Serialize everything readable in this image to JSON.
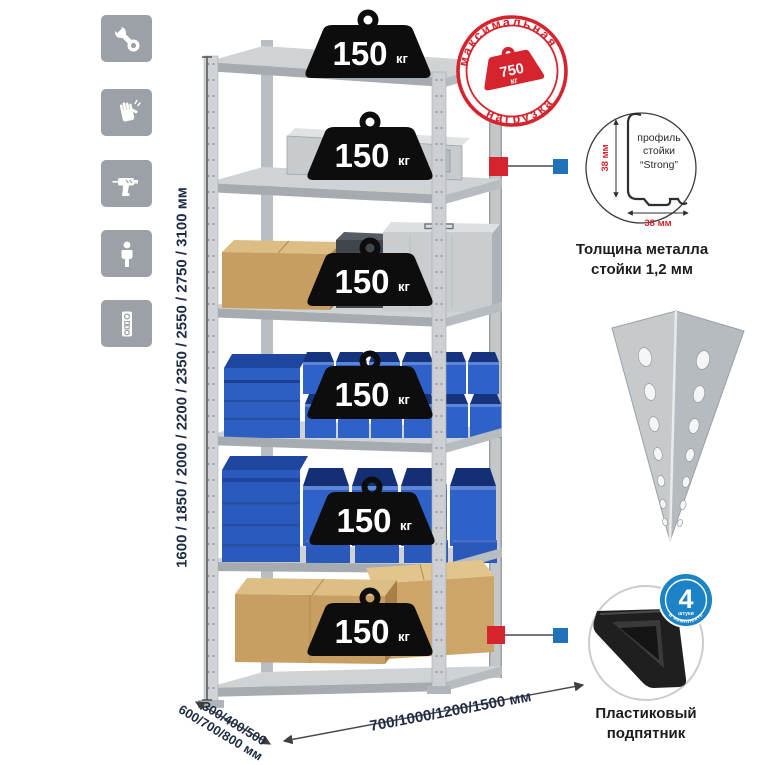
{
  "window": {
    "width": 765,
    "height": 765,
    "background": "#ffffff"
  },
  "feature_icons": [
    {
      "name": "wrench-icon"
    },
    {
      "name": "gloves-icon"
    },
    {
      "name": "drill-icon"
    },
    {
      "name": "person-icon"
    },
    {
      "name": "level-icon"
    }
  ],
  "rack": {
    "shelf_count": 6,
    "shelves": [
      {
        "load_value": "150",
        "load_unit": "кг"
      },
      {
        "load_value": "150",
        "load_unit": "кг"
      },
      {
        "load_value": "150",
        "load_unit": "кг"
      },
      {
        "load_value": "150",
        "load_unit": "кг"
      },
      {
        "load_value": "150",
        "load_unit": "кг"
      },
      {
        "load_value": "150",
        "load_unit": "кг"
      }
    ]
  },
  "stamp": {
    "top_text": "максимальная",
    "bottom_text": "нагрузка",
    "value": "750",
    "unit": "кг",
    "color": "#d5242e"
  },
  "dims": {
    "height_label": "1600 / 1850 / 2000 / 2200 / 2350 / 2550 / 2750 / 3100 мм",
    "depth_line1": "300/400/500",
    "depth_line2": "600/700/800 мм",
    "width_label": "700/1000/1200/1500 мм",
    "text_color": "#1f2c45"
  },
  "profile": {
    "vertical_dim": "38 мм",
    "horizontal_dim": "38 мм",
    "label_lines": [
      "профиль",
      "стойки",
      "“Strong”"
    ],
    "caption_line1": "Толщина металла",
    "caption_line2": "стойки 1,2 мм"
  },
  "foot": {
    "badge_value": "4",
    "badge_small": "штуки",
    "badge_arc": "в комплекте",
    "badge_color": "#1b83c6",
    "caption_line1": "Пластиковый",
    "caption_line2": "подпятник"
  },
  "colors": {
    "marker_red": "#d5242e",
    "marker_blue": "#2173b9",
    "bin_blue": "#2e62c8",
    "steel_gray": "#ccd0d3",
    "cardboard": "#c89f63",
    "icon_gray": "#9ba1a6"
  }
}
